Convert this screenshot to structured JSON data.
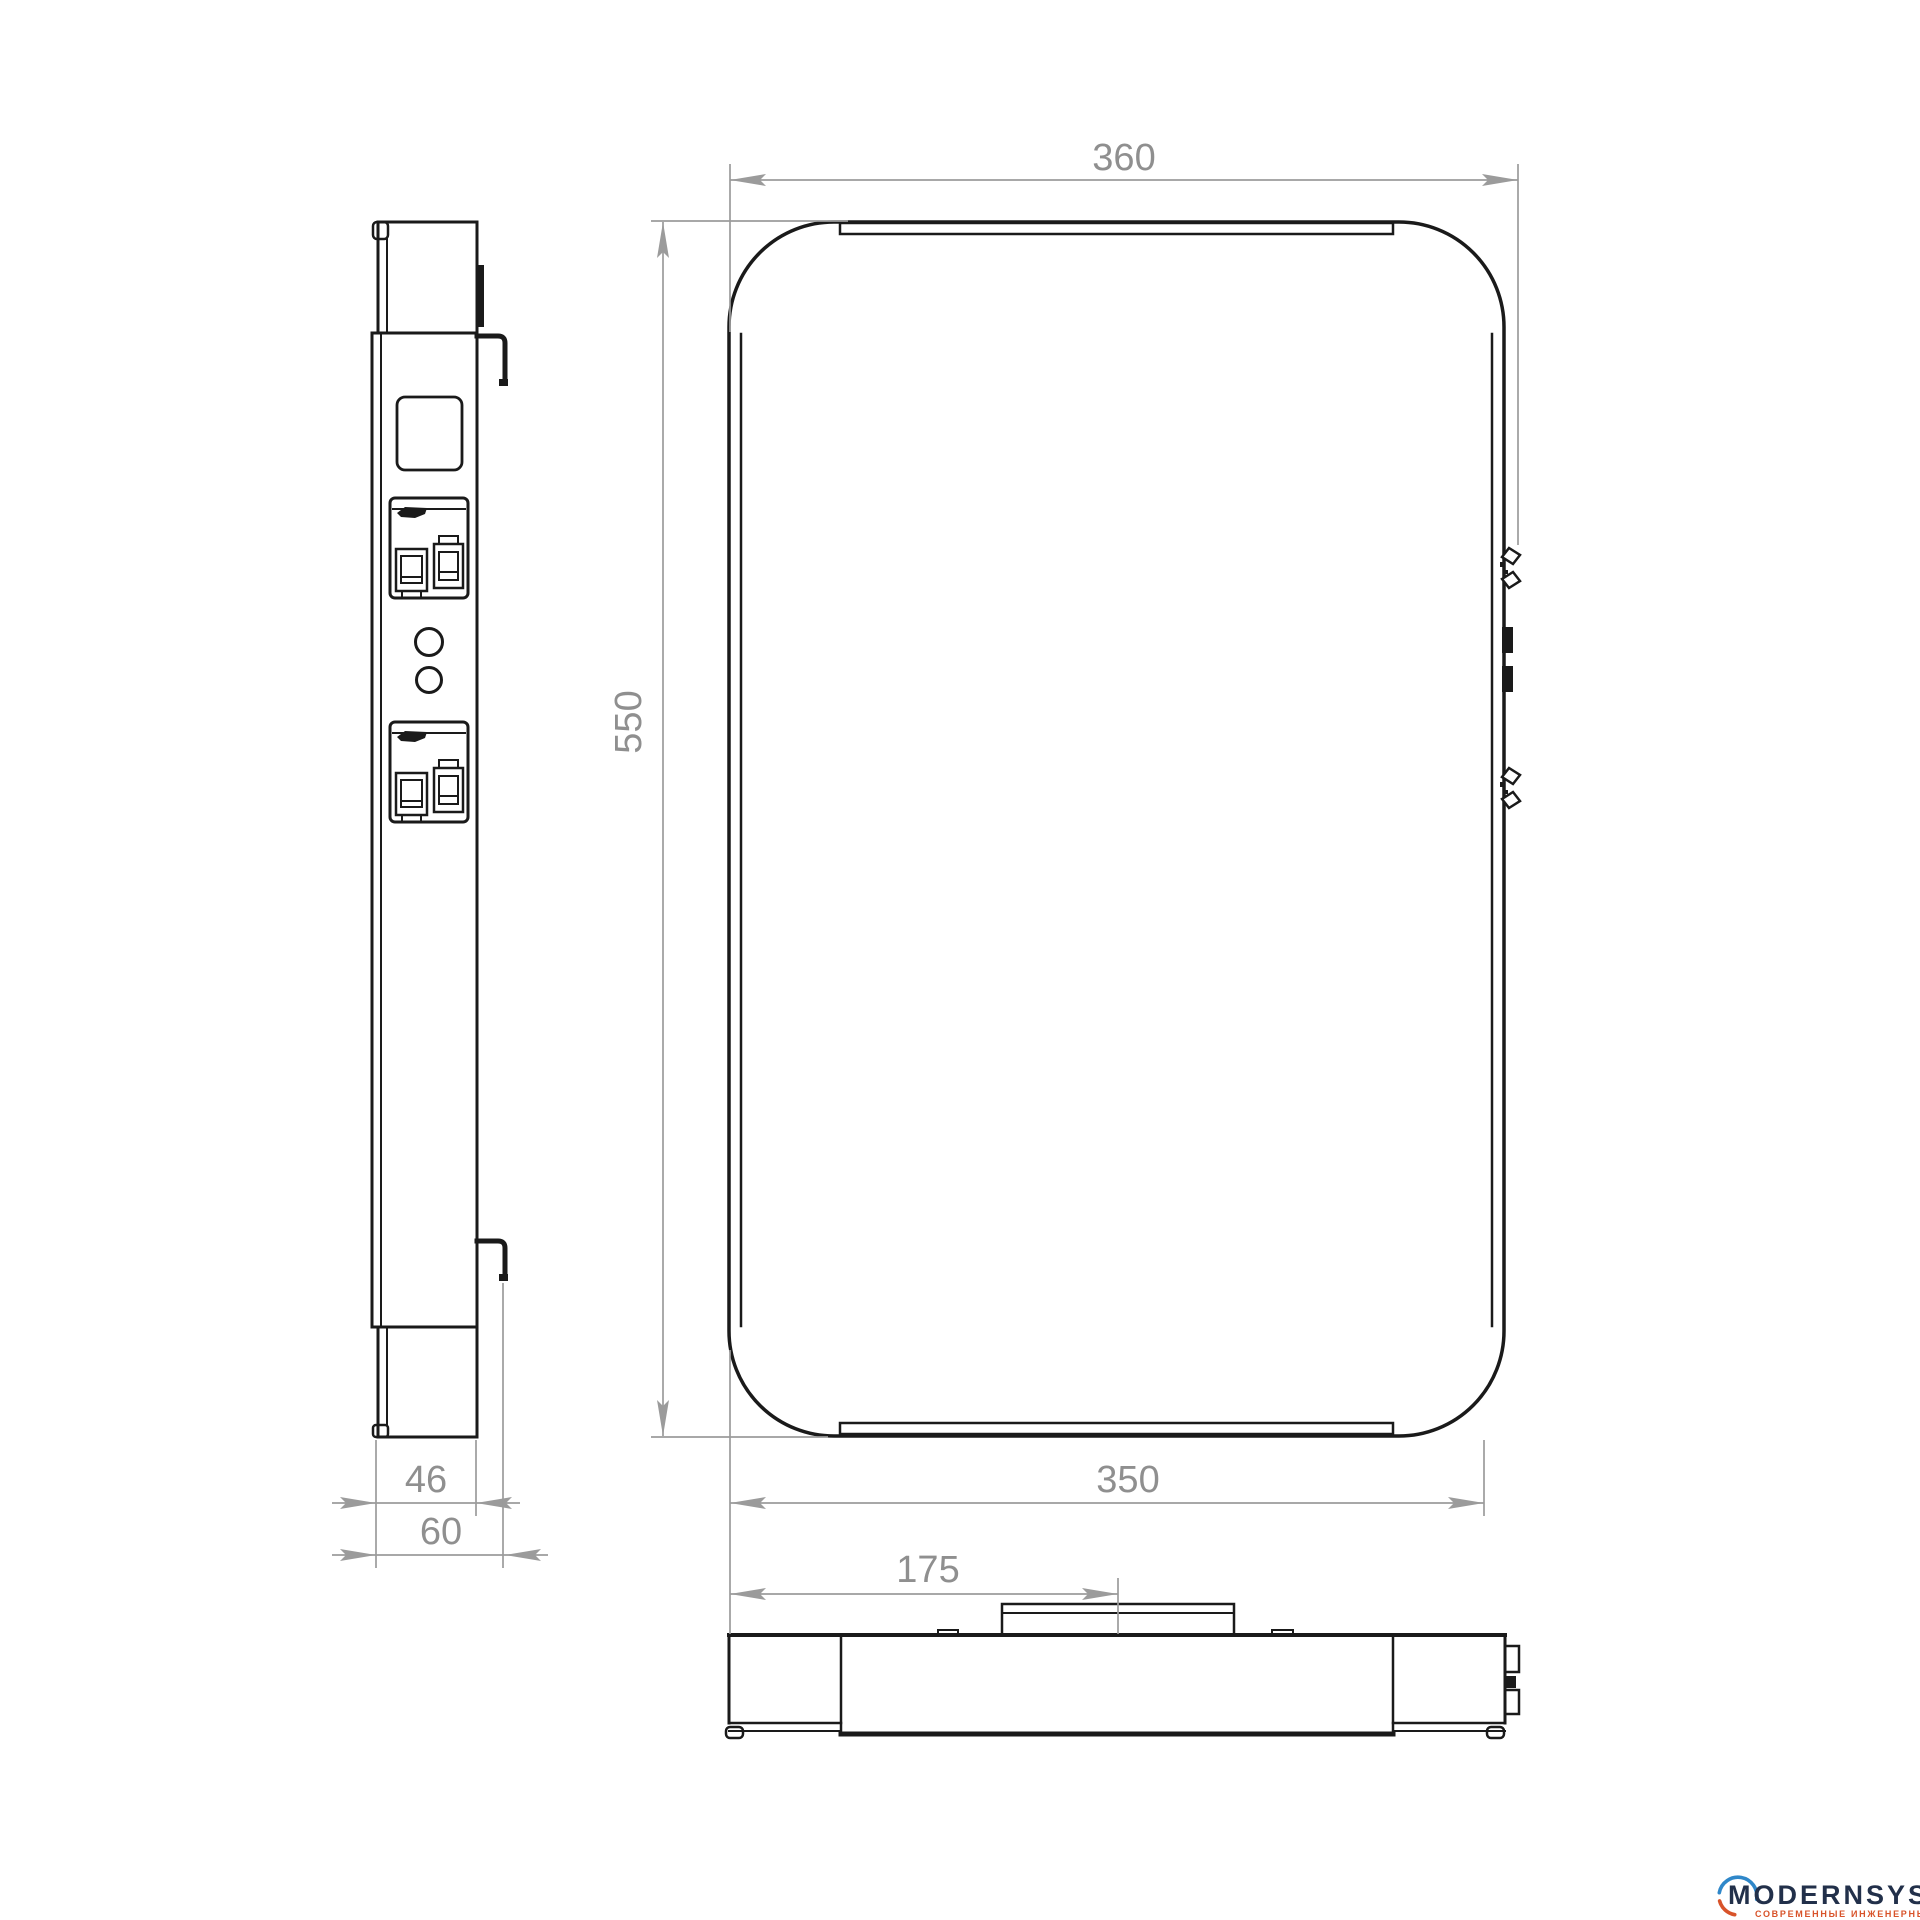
{
  "drawing": {
    "dims": {
      "top_width": "360",
      "height": "550",
      "bottom_width": "350",
      "center_offset": "175",
      "body_depth": "46",
      "total_depth": "60"
    }
  },
  "logo": {
    "brand": "MODERNSYS",
    "tagline": "СОВРЕМЕННЫЕ ИНЖЕНЕРНЫЕ СИСТЕМЫ"
  },
  "colors": {
    "line": "#1a1a1a",
    "dimension": "#9b9b9b",
    "dimension_text": "#8f8f8f",
    "background": "#ffffff",
    "logo_navy": "#22304a",
    "logo_blue": "#2f87c9",
    "logo_orange": "#d8532a"
  }
}
